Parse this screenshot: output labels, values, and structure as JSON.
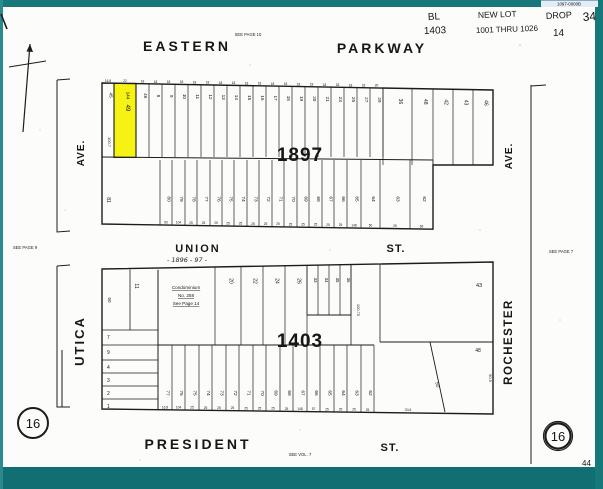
{
  "watermark": "1097-0000B",
  "header": {
    "bl_label": "BL",
    "bl_value": "1403",
    "new_lot_label": "NEW LOT",
    "new_lot_value": "1001 THRU 1026",
    "drop_label": "DROP",
    "drop_value": "14",
    "sheet_note": "34"
  },
  "page_number": "44",
  "page_circles": {
    "left": "16",
    "right": "16"
  },
  "cross_refs": {
    "top": "SEE PAGE 10",
    "left": "SEE PAGE 9",
    "right": "SEE PAGE 7",
    "bottom": "SEE VOL. 7"
  },
  "streets": {
    "eastern": "EASTERN",
    "parkway": "PARKWAY",
    "union": "UNION",
    "union_st": "ST.",
    "union_years": "- 1896 - 97 -",
    "president": "PRESIDENT",
    "president_st": "ST.",
    "ave_left": "AVE.",
    "utica": "UTICA",
    "ave_right": "AVE.",
    "rochester": "ROCHESTER"
  },
  "block_1897": {
    "number": "1897",
    "highlight_color": "#f6f214",
    "highlight_lot": {
      "top_label": "144",
      "number": "49"
    },
    "dim_left": "100.7",
    "union_left_lot": "81",
    "parkway_lots": [
      "45",
      "144",
      "46",
      "8",
      "9",
      "10",
      "11",
      "12",
      "13",
      "14",
      "15",
      "16",
      "17",
      "18",
      "19",
      "20",
      "21",
      "23",
      "25",
      "27",
      "29"
    ],
    "parkway_dims": [
      "16.8",
      "22",
      "18",
      "18",
      "18",
      "18",
      "18",
      "18",
      "18",
      "18",
      "18",
      "18",
      "18",
      "18",
      "18",
      "18",
      "18",
      "18",
      "18",
      "18",
      "20"
    ],
    "right_lots": [
      "36",
      "48",
      "42",
      "43",
      "46"
    ],
    "union_lots": [
      "80",
      "79",
      "78",
      "77",
      "76",
      "75",
      "74",
      "73",
      "72",
      "71",
      "70",
      "69",
      "68",
      "67",
      "66",
      "65",
      "64",
      "63",
      "62"
    ],
    "union_dims": [
      "50",
      "104",
      "25",
      "25",
      "25",
      "25",
      "25",
      "25",
      "25",
      "25",
      "25",
      "25",
      "25",
      "25",
      "25",
      "148",
      "50",
      "25",
      "69"
    ]
  },
  "block_1403": {
    "number": "1403",
    "condo_note": [
      "Condominium",
      "No. 258",
      "See Page 14"
    ],
    "union_lots": [
      "20",
      "22",
      "24",
      "26"
    ],
    "small_lots": [
      "33",
      "34",
      "35",
      "36"
    ],
    "big_lot": "43",
    "corner_lot": "48",
    "corner_dim": "90.5",
    "diagonal_lot": "50",
    "bottom_dim": "314",
    "mid_dim": "100.75",
    "left_lot_dim": "50",
    "left_lot_number": "11",
    "left_lots": [
      "7",
      "9",
      "4",
      "3",
      "2",
      "1"
    ],
    "president_lots": [
      "77",
      "76",
      "75",
      "74",
      "73",
      "72",
      "71",
      "70",
      "69",
      "68",
      "67",
      "66",
      "65",
      "64",
      "63",
      "62"
    ],
    "president_dims": [
      "16.8",
      "104",
      "25",
      "25",
      "25",
      "25",
      "25",
      "25",
      "25",
      "25",
      "148",
      "57",
      "25",
      "25",
      "25",
      "25"
    ]
  }
}
